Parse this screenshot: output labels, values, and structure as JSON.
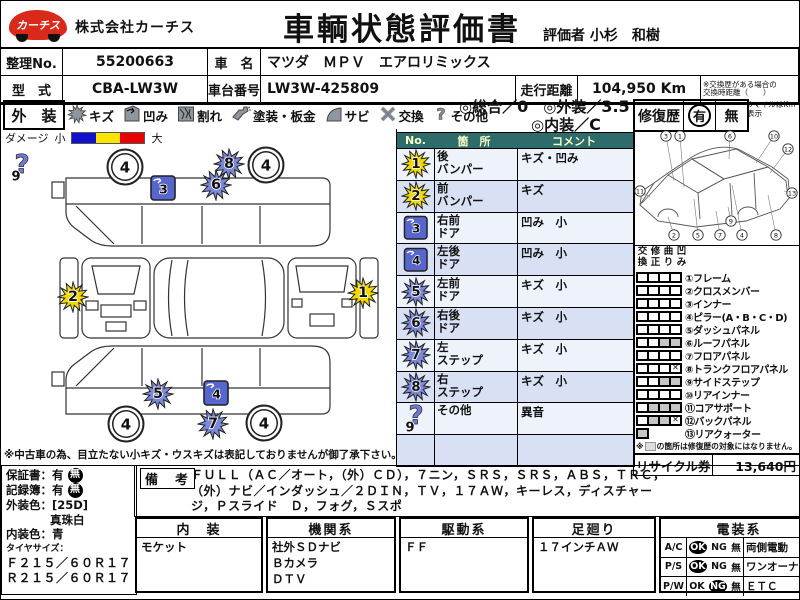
{
  "header": {
    "logo_text": "カーチス",
    "company": "株式会社カーチス",
    "title": "車輌状態評価書",
    "evaluator_label": "評価者",
    "evaluator_name": "小杉　和樹"
  },
  "info": {
    "serial_label": "整理No.",
    "serial": "55200663",
    "name_label": "車　名",
    "name": "マツダ　ＭＰＶ　エアロリミックス",
    "model_label": "型　式",
    "model": "CBA-LW3W",
    "chassis_label": "車台番号",
    "chassis": "LW3W-425809",
    "mileage_label": "走行距離",
    "mileage": "104,950 Km",
    "mileage_note": "※交換歴がある場合の\n交換時距離（　　）",
    "mile_note": "※マイルはKm表示"
  },
  "exterior": {
    "label": "外　装",
    "icons": [
      {
        "type": "scratch",
        "label": "キズ"
      },
      {
        "type": "dent",
        "label": "凹み"
      },
      {
        "type": "crack",
        "label": "割れ"
      },
      {
        "type": "paint",
        "label": "塗装・板金"
      },
      {
        "type": "rust",
        "label": "サビ"
      },
      {
        "type": "replace",
        "label": "交換"
      },
      {
        "type": "other",
        "label": "その他"
      }
    ],
    "scores": {
      "overall_label": "◎総合／",
      "overall_value": "0",
      "ext_label": "◎外装／",
      "ext_value": "3.5",
      "int_label": "◎内装／",
      "int_value": "C"
    },
    "repair": {
      "label": "修復歴",
      "yes": "有",
      "no": "無",
      "selected": "有"
    },
    "scale": {
      "label": "ダメージ",
      "small": "小",
      "large": "大",
      "colors": [
        "#1212cc",
        "#ffe400",
        "#e80000"
      ]
    }
  },
  "damage_table": {
    "headers": [
      "No.",
      "箇　所",
      "コメント"
    ],
    "rows": [
      {
        "no": "1",
        "icon": "star",
        "color": "#f0d800",
        "part": "後\nバンパー",
        "comment": "キズ・凹み"
      },
      {
        "no": "2",
        "icon": "star",
        "color": "#f0d800",
        "part": "前\nバンパー",
        "comment": "キズ"
      },
      {
        "no": "3",
        "icon": "square",
        "color": "#5766cf",
        "part": "右前\nドア",
        "comment": "凹み　小"
      },
      {
        "no": "4",
        "icon": "square",
        "color": "#5766cf",
        "part": "左後\nドア",
        "comment": "凹み　小"
      },
      {
        "no": "5",
        "icon": "star",
        "color": "#7c88d8",
        "part": "左前\nドア",
        "comment": "キズ　小"
      },
      {
        "no": "6",
        "icon": "star",
        "color": "#7c88d8",
        "part": "右後\nドア",
        "comment": "キズ　小"
      },
      {
        "no": "7",
        "icon": "star",
        "color": "#7c88d8",
        "part": "左\nステップ",
        "comment": "キズ　小"
      },
      {
        "no": "8",
        "icon": "star",
        "color": "#7c88d8",
        "part": "右\nステップ",
        "comment": "キズ　小"
      },
      {
        "no": "9",
        "icon": "question",
        "color": "#6f7bd4",
        "part": "その他",
        "comment": "異音"
      }
    ],
    "visible_row_slots": 10
  },
  "diagram": {
    "wheel_value": "4",
    "wheels": [
      {
        "x": 123,
        "y": 21
      },
      {
        "x": 264,
        "y": 19
      },
      {
        "x": 124,
        "y": 278
      },
      {
        "x": 262,
        "y": 277
      }
    ],
    "markers": [
      {
        "no": "9",
        "icon": "question",
        "color": "#6f7bd4",
        "x": 20,
        "y": 24
      },
      {
        "no": "8",
        "icon": "star",
        "color": "#7c88d8",
        "x": 227,
        "y": 20
      },
      {
        "no": "6",
        "icon": "star",
        "color": "#7c88d8",
        "x": 214,
        "y": 41
      },
      {
        "no": "3",
        "icon": "square",
        "color": "#5766cf",
        "x": 161,
        "y": 44
      },
      {
        "no": "2",
        "icon": "star",
        "color": "#f0d800",
        "x": 71,
        "y": 153
      },
      {
        "no": "1",
        "icon": "star",
        "color": "#f0d800",
        "x": 361,
        "y": 149
      },
      {
        "no": "5",
        "icon": "star",
        "color": "#7c88d8",
        "x": 156,
        "y": 250
      },
      {
        "no": "4",
        "icon": "square",
        "color": "#5766cf",
        "x": 214,
        "y": 249
      },
      {
        "no": "7",
        "icon": "star",
        "color": "#7c88d8",
        "x": 211,
        "y": 280
      }
    ]
  },
  "frame": {
    "col_headers": [
      "交換",
      "修正",
      "曲り",
      "凹み"
    ],
    "parts": [
      {
        "label": "①フレーム",
        "cells": [
          "w",
          "w",
          "w",
          "w"
        ]
      },
      {
        "label": "②クロスメンバー",
        "cells": [
          "w",
          "w",
          "w",
          "w"
        ]
      },
      {
        "label": "③インナー",
        "cells": [
          "w",
          "w",
          "w",
          "w"
        ]
      },
      {
        "label": "④ピラー(A・B・C・D)",
        "cells": [
          "w",
          "w",
          "w",
          "w"
        ]
      },
      {
        "label": "⑤ダッシュパネル",
        "cells": [
          "w",
          "w",
          "w",
          "w"
        ]
      },
      {
        "label": "⑥ルーフパネル",
        "cells": [
          "w",
          "w",
          "g",
          "g"
        ]
      },
      {
        "label": "⑦フロアパネル",
        "cells": [
          "w",
          "w",
          "w",
          "w"
        ]
      },
      {
        "label": "⑧トランクフロアパネル",
        "cells": [
          "w",
          "w",
          "w",
          "x"
        ]
      },
      {
        "label": "⑨サイドステップ",
        "cells": [
          "w",
          "w",
          "g",
          "g"
        ]
      },
      {
        "label": "⑩リアインナー",
        "cells": [
          "w",
          "w",
          "w",
          "w"
        ]
      },
      {
        "label": "⑪コアサポート",
        "cells": [
          "w",
          "g",
          "g",
          "g"
        ]
      },
      {
        "label": "⑫バックパネル",
        "cells": [
          "w",
          "g",
          "g",
          "x"
        ]
      },
      {
        "label": "⑬リアクォーター",
        "cells": [
          "g",
          null,
          null,
          null
        ]
      }
    ],
    "callouts": [
      {
        "num": "3",
        "x": 32,
        "y": 7,
        "tx": 40,
        "ty": 52
      },
      {
        "num": "1",
        "x": 46,
        "y": 7,
        "tx": 50,
        "ty": 58
      },
      {
        "num": "6",
        "x": 96,
        "y": 7,
        "tx": 95,
        "ty": 30
      },
      {
        "num": "10",
        "x": 140,
        "y": 7,
        "tx": 122,
        "ty": 34
      },
      {
        "num": "12",
        "x": 154,
        "y": 20,
        "tx": 136,
        "ty": 44
      },
      {
        "num": "11",
        "x": 6,
        "y": 62,
        "tx": 16,
        "ty": 68
      },
      {
        "num": "2",
        "x": 40,
        "y": 106,
        "tx": 34,
        "ty": 88
      },
      {
        "num": "5",
        "x": 64,
        "y": 106,
        "tx": 60,
        "ty": 70
      },
      {
        "num": "7",
        "x": 86,
        "y": 106,
        "tx": 82,
        "ty": 82
      },
      {
        "num": "9",
        "x": 97,
        "y": 92,
        "tx": 94,
        "ty": 78
      },
      {
        "num": "4",
        "x": 108,
        "y": 106,
        "tx": 98,
        "ty": 56
      },
      {
        "num": "8",
        "x": 142,
        "y": 106,
        "tx": 134,
        "ty": 66
      },
      {
        "num": "13",
        "x": 158,
        "y": 64,
        "tx": 150,
        "ty": 62
      }
    ],
    "note_prefix": "※",
    "note_text": "の箇所は修復歴の対象にはなりません。",
    "recycle_label": "リサイクル券",
    "recycle_value": "13,640円"
  },
  "notes": {
    "used_car": "※中古車の為、目立たない小キズ・ウスキズは表記しておりませんが御了承下さい。"
  },
  "left_info": {
    "warranty_label": "保証書：",
    "warranty_yes": "有",
    "warranty_no": "無",
    "warranty_selected": "無",
    "record_label": "記録簿：",
    "record_yes": "有",
    "record_no": "無",
    "record_selected": "無",
    "ext_color_label": "外装色：",
    "ext_color_code": "[25D]",
    "ext_color_name": "真珠白",
    "int_color_label": "内装色：",
    "int_color": "青",
    "tire_label": "タイヤサイズ：",
    "tire_front": "Ｆ２１５／６０Ｒ１７",
    "tire_rear": "Ｒ２１５／６０Ｒ１７"
  },
  "remarks": {
    "label": "備　考",
    "text": "ＦＵＬＬ（ＡＣ／オート，（外）ＣＤ），７ニン，ＳＲＳ，ＳＲＳ，ＡＢＳ，ＴＲＣ，（外）ナビ／インダッシュ／２ＤＩＮ，ＴＶ，１７ＡＷ，キーレス，ディスチャージ，Ｐスライド　Ｄ，フォグ，Ｓスポ"
  },
  "bottom": {
    "columns": [
      {
        "header": "内　装",
        "lines": [
          "モケット"
        ]
      },
      {
        "header": "機関系",
        "lines": [
          "社外ＳＤナビ",
          "Ｂカメラ",
          "ＤＴＶ"
        ]
      },
      {
        "header": "駆動系",
        "lines": [
          "ＦＦ"
        ]
      },
      {
        "header": "足廻り",
        "lines": [
          "１７インチＡＷ"
        ]
      }
    ],
    "electrical": {
      "header": "電装系",
      "rows": [
        {
          "label": "A/C",
          "ok": "OK",
          "ng": "NG",
          "none": "無",
          "selected": "ok",
          "extra": "両側電動"
        },
        {
          "label": "P/S",
          "ok": "OK",
          "ng": "NG",
          "none": "無",
          "selected": "ok",
          "extra": "ワンオーナー車"
        },
        {
          "label": "P/W",
          "ok": "OK",
          "ng": "NG",
          "none": "無",
          "selected": "ng",
          "extra": "ＥＴＣ"
        }
      ]
    }
  }
}
